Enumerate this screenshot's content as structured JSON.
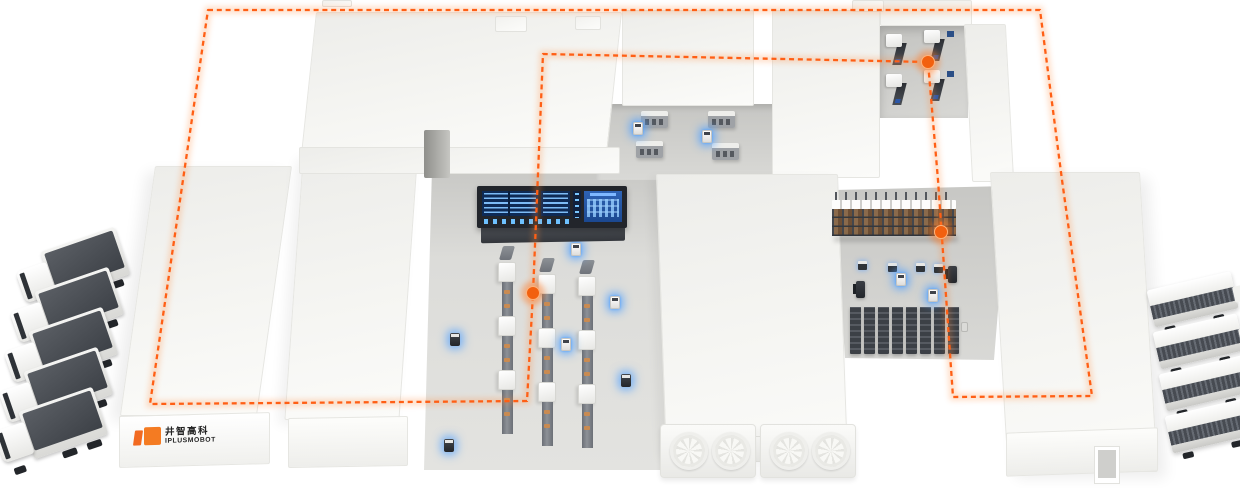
{
  "scene": {
    "description": "Isometric smart-factory and warehouse logistics illustration with AGV route",
    "colors": {
      "route_orange": "#ff5f15",
      "glow_blue": "#4da6ff",
      "roof_white": "#f5f5f2",
      "floor_gray": "#d8d8d5",
      "screen_navy": "#0e2a55",
      "screen_blue": "#2458a8",
      "rack_brown": "#8a6a4b",
      "truck_dark": "#43474d",
      "logo_orange": "#f47b22"
    },
    "logo": {
      "text_cn": "井智高科",
      "text_en": "IPLUSMOBOT"
    },
    "route": {
      "style": "dashed",
      "color": "#ff5f15",
      "closed": true,
      "points": [
        [
          208,
          10
        ],
        [
          1040,
          10
        ],
        [
          1062,
          180
        ],
        [
          1092,
          396
        ],
        [
          953,
          397
        ],
        [
          938,
          180
        ],
        [
          928,
          62
        ],
        [
          543,
          54
        ],
        [
          533,
          293
        ],
        [
          527,
          401
        ],
        [
          150,
          404
        ]
      ],
      "waypoints": [
        [
          533,
          293
        ],
        [
          928,
          62
        ],
        [
          941,
          232
        ]
      ]
    },
    "fleet": {
      "trucks_left": {
        "count": 5,
        "positions": [
          [
            18,
            240
          ],
          [
            12,
            280
          ],
          [
            6,
            320
          ],
          [
            1,
            360
          ],
          [
            -4,
            400
          ]
        ]
      },
      "trailers_right": {
        "count": 4,
        "positions": [
          [
            1148,
            280
          ],
          [
            1154,
            322
          ],
          [
            1160,
            364
          ],
          [
            1166,
            406
          ]
        ]
      }
    },
    "equipment": {
      "conveyor_lines": {
        "count": 3,
        "positions": [
          [
            498,
            246
          ],
          [
            538,
            258
          ],
          [
            578,
            260
          ]
        ]
      },
      "machining_centers": {
        "count": 4,
        "positions": [
          [
            884,
            34
          ],
          [
            922,
            30
          ],
          [
            884,
            74
          ],
          [
            922,
            70
          ]
        ]
      },
      "storage_cabinets": {
        "count": 4,
        "positions": [
          [
            641,
            111
          ],
          [
            708,
            111
          ],
          [
            636,
            141
          ],
          [
            712,
            143
          ]
        ]
      },
      "long_rack": {
        "position": [
          832,
          192
        ]
      },
      "rack_shuttles": {
        "positions": [
          [
            858,
            261
          ],
          [
            888,
            263
          ],
          [
            916,
            263
          ],
          [
            934,
            264
          ]
        ]
      },
      "rack_columns": {
        "count": 8,
        "start": [
          850,
          306
        ],
        "step": 14
      },
      "hvac_fan_units": {
        "count": 2,
        "positions": [
          [
            660,
            424
          ],
          [
            760,
            424
          ]
        ],
        "fans_per_unit": 2
      }
    },
    "robots": {
      "agvs_white": [
        [
          571,
          243
        ],
        [
          610,
          296
        ],
        [
          561,
          338
        ],
        [
          633,
          122
        ],
        [
          702,
          130
        ],
        [
          896,
          273
        ],
        [
          928,
          289
        ]
      ],
      "agvs_dark": [
        [
          450,
          333
        ],
        [
          444,
          439
        ],
        [
          621,
          374
        ]
      ],
      "forklifts": [
        [
          856,
          281
        ],
        [
          948,
          266
        ]
      ],
      "mini_bots": [
        [
          961,
          322
        ]
      ]
    },
    "dashboard": {
      "position": [
        477,
        186
      ],
      "panels": [
        "data-table-left",
        "data-table-mid",
        "status-indicators",
        "schematic-right"
      ]
    }
  }
}
